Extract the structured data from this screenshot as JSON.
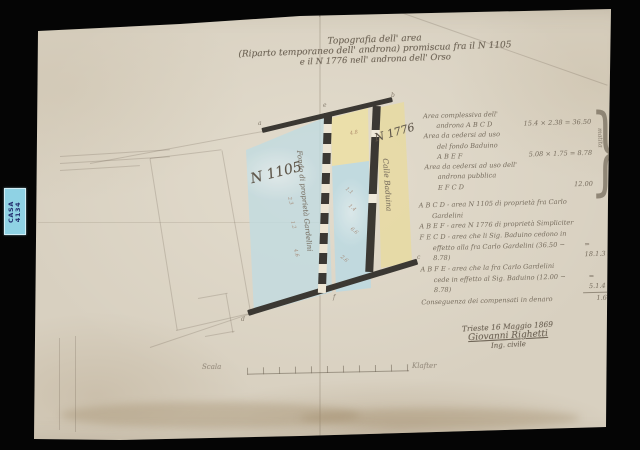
{
  "archive_label": {
    "line1": "CASA",
    "line2": "4134"
  },
  "title": {
    "cross_mark": "+",
    "line1": "Topografia dell' area",
    "line2": "(Riparto temporaneo dell' androna) promiscua fra il N 1105",
    "line3": "e il N 1776 nell' androna dell' Orso"
  },
  "map": {
    "parcel_left_label": "N 1105",
    "parcel_right_label": "N 1776",
    "boundary_note": "Fondo di proprietà Gardelini",
    "calle_label": "Calle Baduina",
    "corner_labels": {
      "a": "a",
      "b": "b",
      "c": "c",
      "d": "d",
      "e": "e",
      "f": "f"
    },
    "measurements": [
      "2.3",
      "1.2",
      "4.6",
      "1.1",
      "1.4",
      "6.6",
      "4.8",
      "2.6"
    ]
  },
  "calculations": {
    "brace_glyph": "}",
    "brace_note": "matita",
    "rows": [
      {
        "text": "Area complessiva dell'",
        "value": ""
      },
      {
        "text": "androna A B C D",
        "value": "15.4 × 2.38 = 36.50"
      },
      {
        "text": "Area da cedersi ad uso",
        "value": ""
      },
      {
        "text": "del fondo Baduino",
        "value": ""
      },
      {
        "text": "A B E F",
        "value": "5.08 × 1.75 = 8.78"
      },
      {
        "text": "Area da cedersi ad uso dell'",
        "value": ""
      },
      {
        "text": "androna pubblica",
        "value": ""
      },
      {
        "text": "E F C D",
        "value": "12.00"
      }
    ]
  },
  "legend": {
    "rows": [
      {
        "text": "A B C D - area N 1105 di proprietà fra Carlo",
        "value": ""
      },
      {
        "text": "Gardelini",
        "value": ""
      },
      {
        "text": "A B E F - area N 1776 di proprietà Simpliciter",
        "value": ""
      },
      {
        "text": "F E C D - area che li Sig. Baduino cedono in",
        "value": ""
      },
      {
        "text": "effetto alla fra Carlo Gardelini (36.50 − 8.78)",
        "value": "= 18.1.3"
      },
      {
        "text": "A B F E - area che la fra Carlo Gardelini",
        "value": ""
      },
      {
        "text": "cede in effetto al Sig. Baduino (12.00 − 8.78)",
        "value": "= 5.1.4"
      },
      {
        "text": "Conseguenza dei compensati in denaro",
        "value": "1.6.8"
      }
    ]
  },
  "signature": {
    "place_date": "Trieste 16 Maggio 1869",
    "name": "Giovanni Righetti",
    "role": "Ing. civile"
  },
  "scale_bar": {
    "left_label": "Scala",
    "right_label": "Klafter"
  },
  "colors": {
    "background": "#000000",
    "paper": "#d8d0c0",
    "ink": "#6f6557",
    "blue_wash": "#bedbe3",
    "yellow_wash": "#e9dca2",
    "dark_band": "#3b3833",
    "label_bg": "#8fd2e4",
    "label_text": "#253070"
  }
}
